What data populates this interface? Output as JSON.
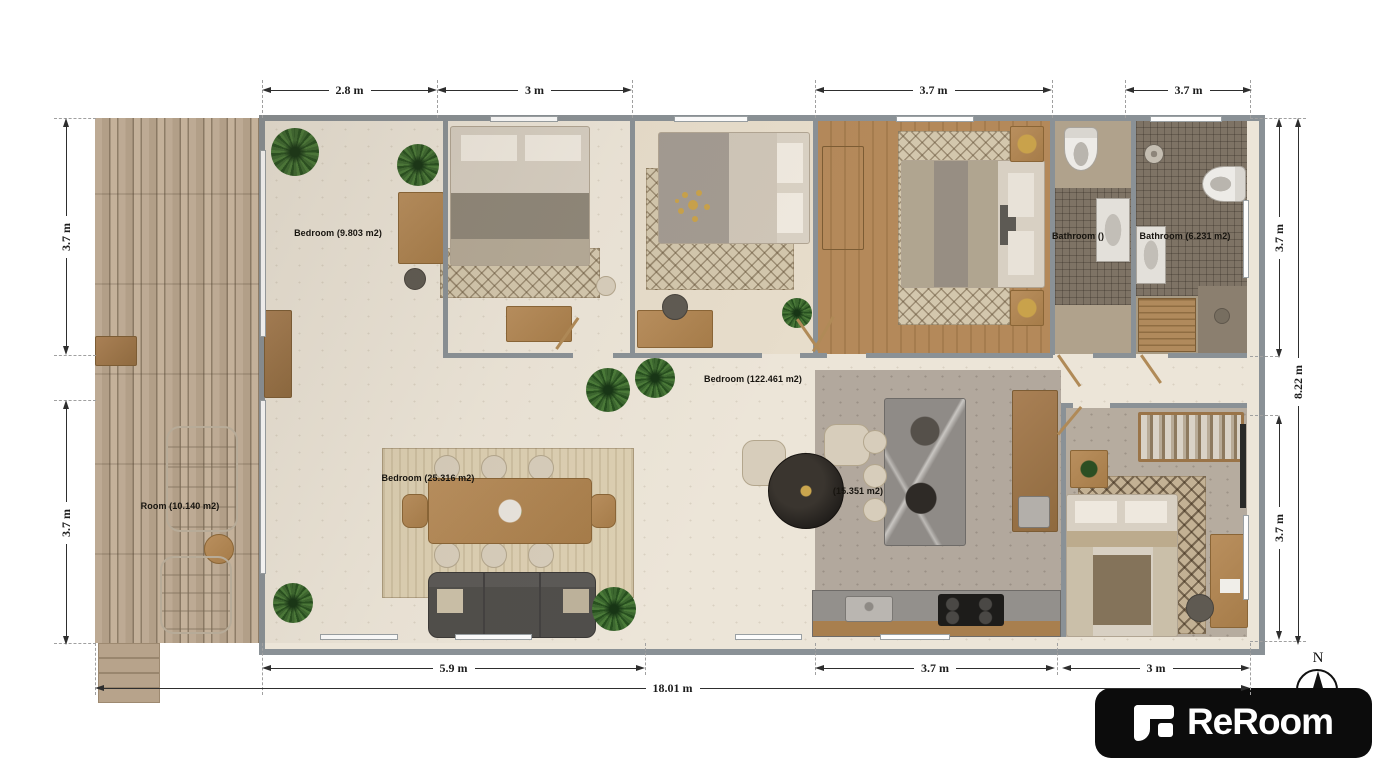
{
  "dimensions": {
    "top": [
      {
        "label": "2.8 m"
      },
      {
        "label": "3 m"
      },
      {
        "label": "3.7 m"
      },
      {
        "label": "3.7 m"
      }
    ],
    "bottom": [
      {
        "label": "5.9 m"
      },
      {
        "label": "3.7 m"
      },
      {
        "label": "3 m"
      }
    ],
    "bottom_total": {
      "label": "18.01 m"
    },
    "left": [
      {
        "label": "3.7 m"
      },
      {
        "label": "3.7 m"
      }
    ],
    "right": [
      {
        "label": "3.7 m"
      },
      {
        "label": "3.7 m"
      }
    ],
    "right_total": {
      "label": "8.22 m"
    }
  },
  "rooms": [
    {
      "id": "bedroom-1",
      "label": "Bedroom (9.803 m2)"
    },
    {
      "id": "hallway",
      "label": "Bedroom (122.461 m2)"
    },
    {
      "id": "living-room",
      "label": "Bedroom (25.316 m2)"
    },
    {
      "id": "deck",
      "label": "Room (10.140 m2)"
    },
    {
      "id": "kitchen",
      "label": "(15.351 m2)"
    },
    {
      "id": "bathroom-1",
      "label": "Bathroom ()"
    },
    {
      "id": "bathroom-2",
      "label": "Bathroom (6.231 m2)"
    }
  ],
  "compass": {
    "label": "N"
  },
  "branding": {
    "logo_text": "ReRoom"
  },
  "palette": {
    "wall": "#8a9196",
    "floor_cream": "#ece5d8",
    "deck_wood": "#c6b39c",
    "wood": "#ad8455",
    "wood_floor": "#b08a5c",
    "tile_dark": "#7e7365",
    "concrete": "#b2a89d",
    "marble": "#8f8b87",
    "sofa": "#504e4b",
    "logo_bg": "#0c0c0c",
    "dimension_line": "#2e2e2e"
  }
}
